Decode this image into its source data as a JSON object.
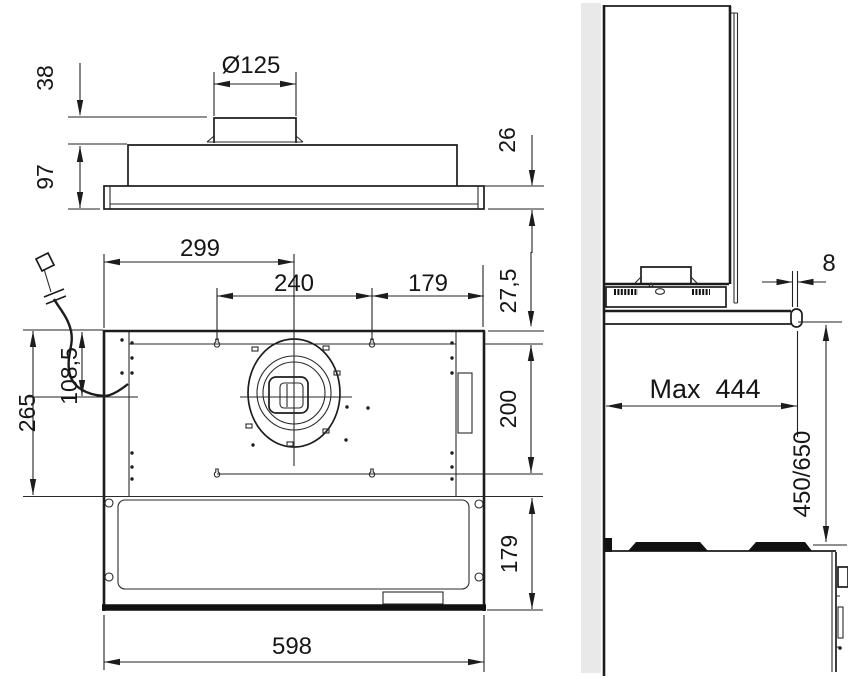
{
  "front_view": {
    "duct_diameter": "Ø125",
    "collar_height": "38",
    "body_height": "97",
    "visor_height": "26"
  },
  "plan_view": {
    "duct_center_from_left": "299",
    "fixing_spacing_width": "240",
    "fixing_to_right": "179",
    "top_edge_to_fixings": "27,5",
    "top_edge_to_duct_center": "108,5",
    "carcass_depth": "265",
    "fixing_spacing_depth": "200",
    "visor_depth": "179",
    "total_width": "598"
  },
  "side_view": {
    "handle_projection": "8",
    "max_depth": "Max  444",
    "hob_clearance": "450/650"
  },
  "colors": {
    "line": "#1c1c1c",
    "wall": "#e9e9e9",
    "background": "#ffffff"
  }
}
